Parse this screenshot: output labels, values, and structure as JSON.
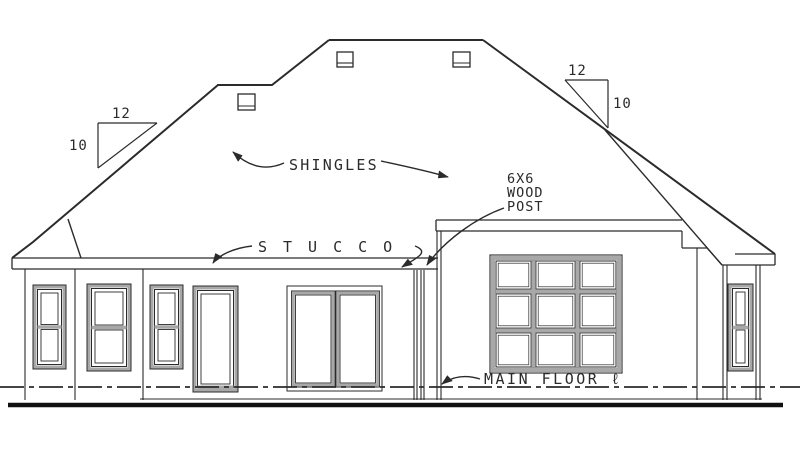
{
  "drawing": {
    "labels": {
      "shingles": "SHINGLES",
      "stucco": "STUCCO",
      "post_line1": "6X6",
      "post_line2": "WOOD",
      "post_line3": "POST",
      "main_floor": "MAIN FLOOR ℓ"
    },
    "pitch_left": {
      "run": "12",
      "rise": "10"
    },
    "pitch_right": {
      "run": "12",
      "rise": "10"
    },
    "colors": {
      "line": "#2b2b2b",
      "window_frame_gray": "#a8a8a8",
      "background": "#ffffff"
    }
  }
}
